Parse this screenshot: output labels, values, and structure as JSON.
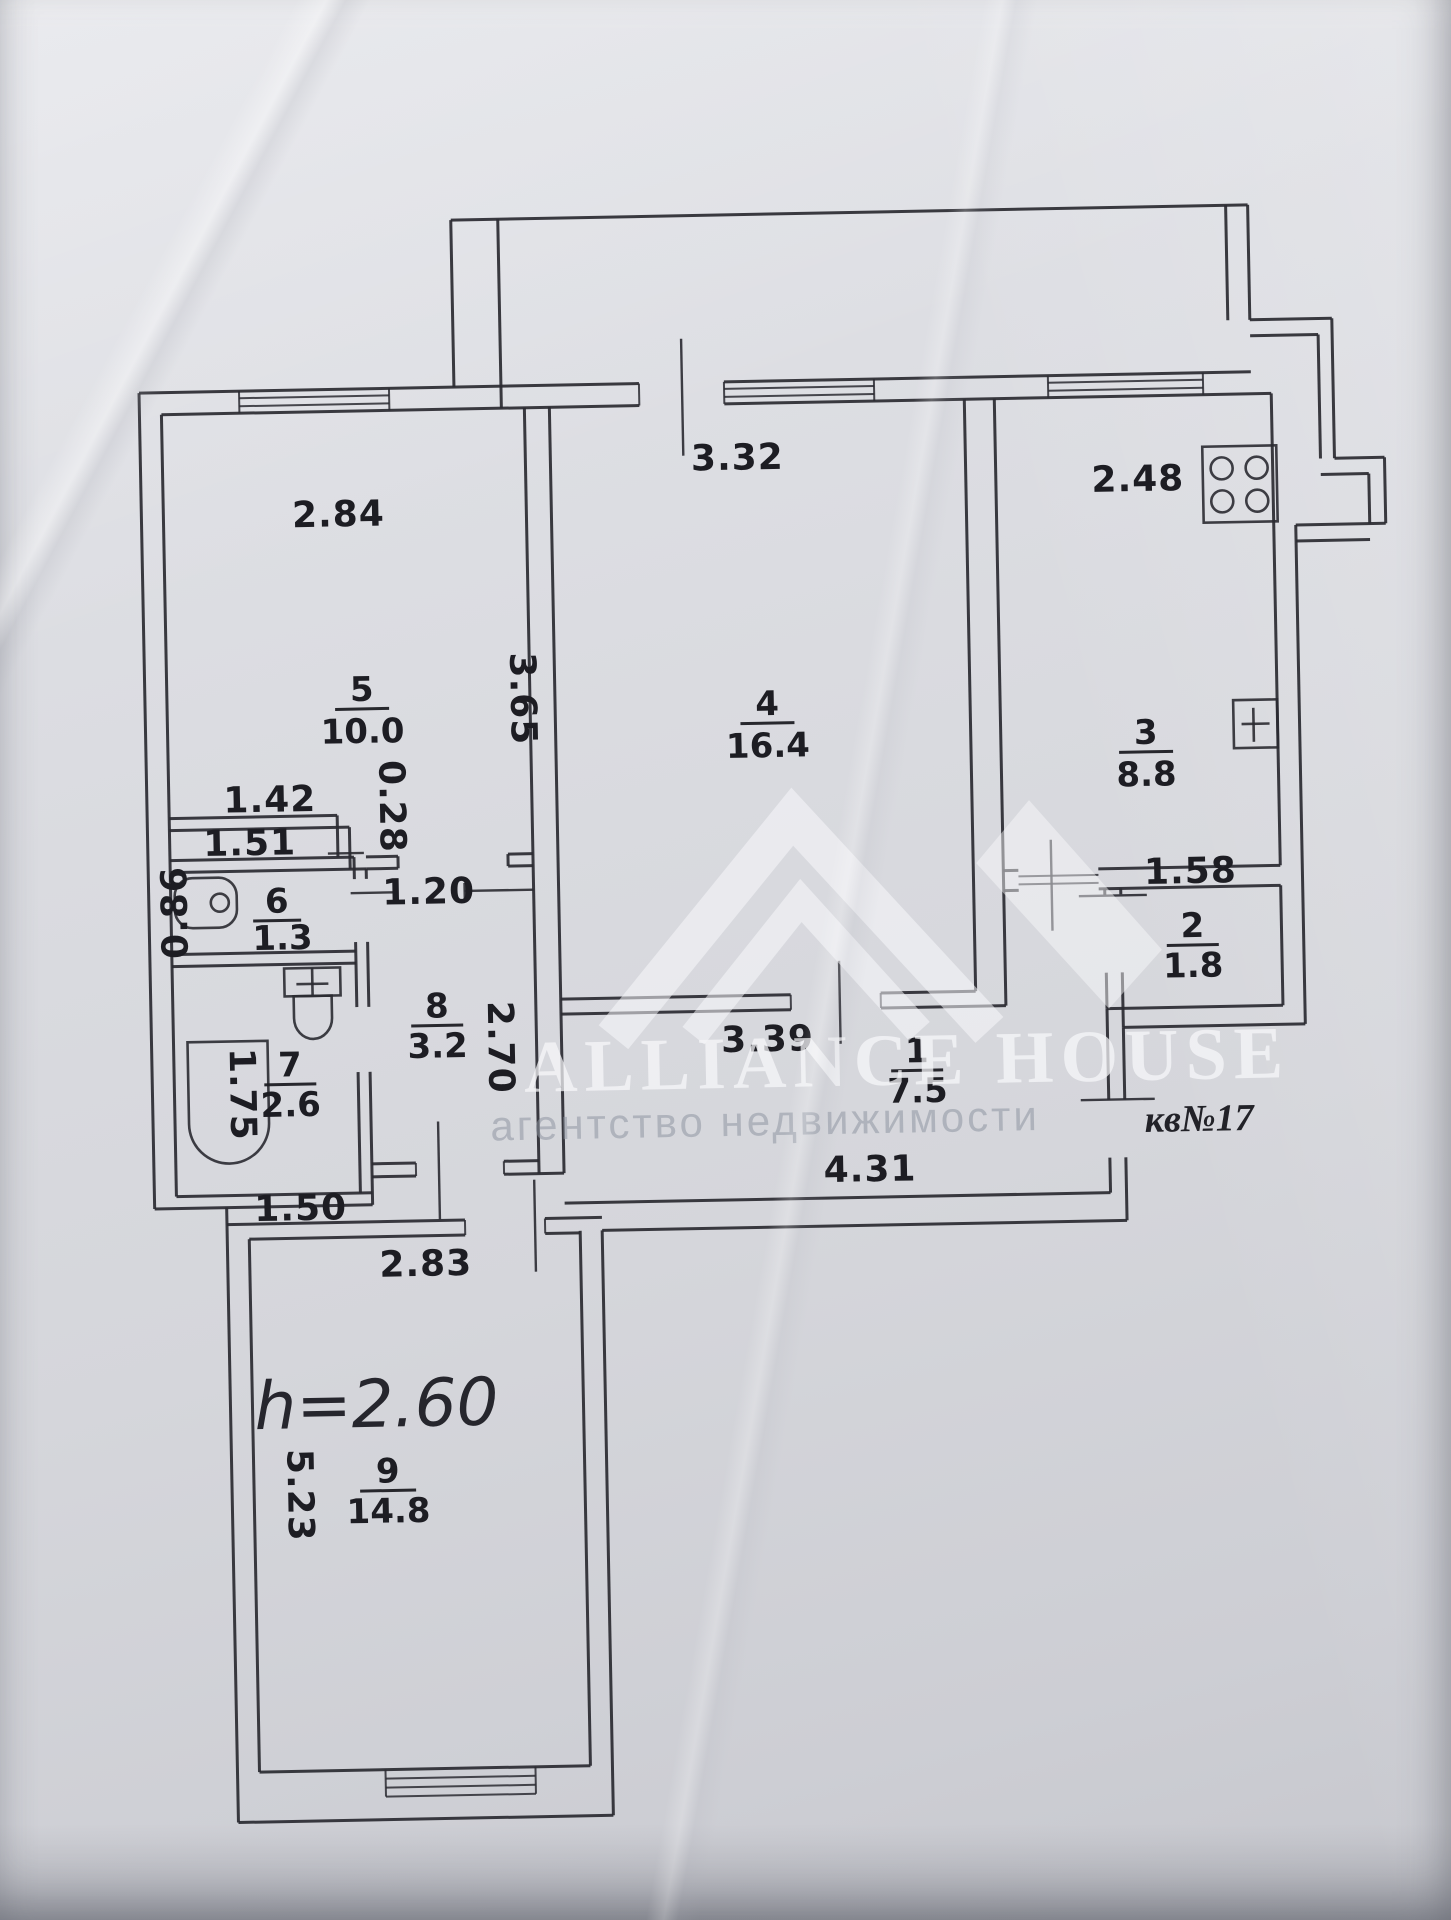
{
  "plan": {
    "rooms": {
      "r1": {
        "number": "1",
        "area": "7.5"
      },
      "r2": {
        "number": "2",
        "area": "1.8"
      },
      "r3": {
        "number": "3",
        "area": "8.8"
      },
      "r4": {
        "number": "4",
        "area": "16.4"
      },
      "r5": {
        "number": "5",
        "area": "10.0"
      },
      "r6": {
        "number": "6",
        "area": "1.3"
      },
      "r7": {
        "number": "7",
        "area": "2.6"
      },
      "r8": {
        "number": "8",
        "area": "3.2"
      },
      "r9": {
        "number": "9",
        "area": "14.8"
      }
    },
    "dimensions": {
      "d284": "2.84",
      "d332": "3.32",
      "d248": "2.48",
      "d365": "3.65",
      "d142": "1.42",
      "d028": "0.28",
      "d151": "1.51",
      "d086": "0.86",
      "d120": "1.20",
      "d270": "2.70",
      "d175": "1.75",
      "d150": "1.50",
      "d339": "3.39",
      "d431": "4.31",
      "d158": "1.58",
      "d283": "2.83",
      "d523": "5.23"
    },
    "annotations": {
      "ceiling_height": "h=2.60",
      "apartment_number": "кв№17"
    },
    "fixtures": {
      "stove": "stove-icon",
      "sink": "sink-icon",
      "washbasin": "washbasin-icon",
      "toilet": "toilet-icon",
      "bathtub": "bathtub-icon"
    }
  },
  "watermark": {
    "title": "ALLIANCE HOUSE",
    "subtitle": "агентство недвижимости"
  },
  "colors": {
    "paper": "#d8d9de",
    "ink": "#2a2a31",
    "watermark_light": "#f7f7fa",
    "watermark_gray": "#8e94a0"
  }
}
